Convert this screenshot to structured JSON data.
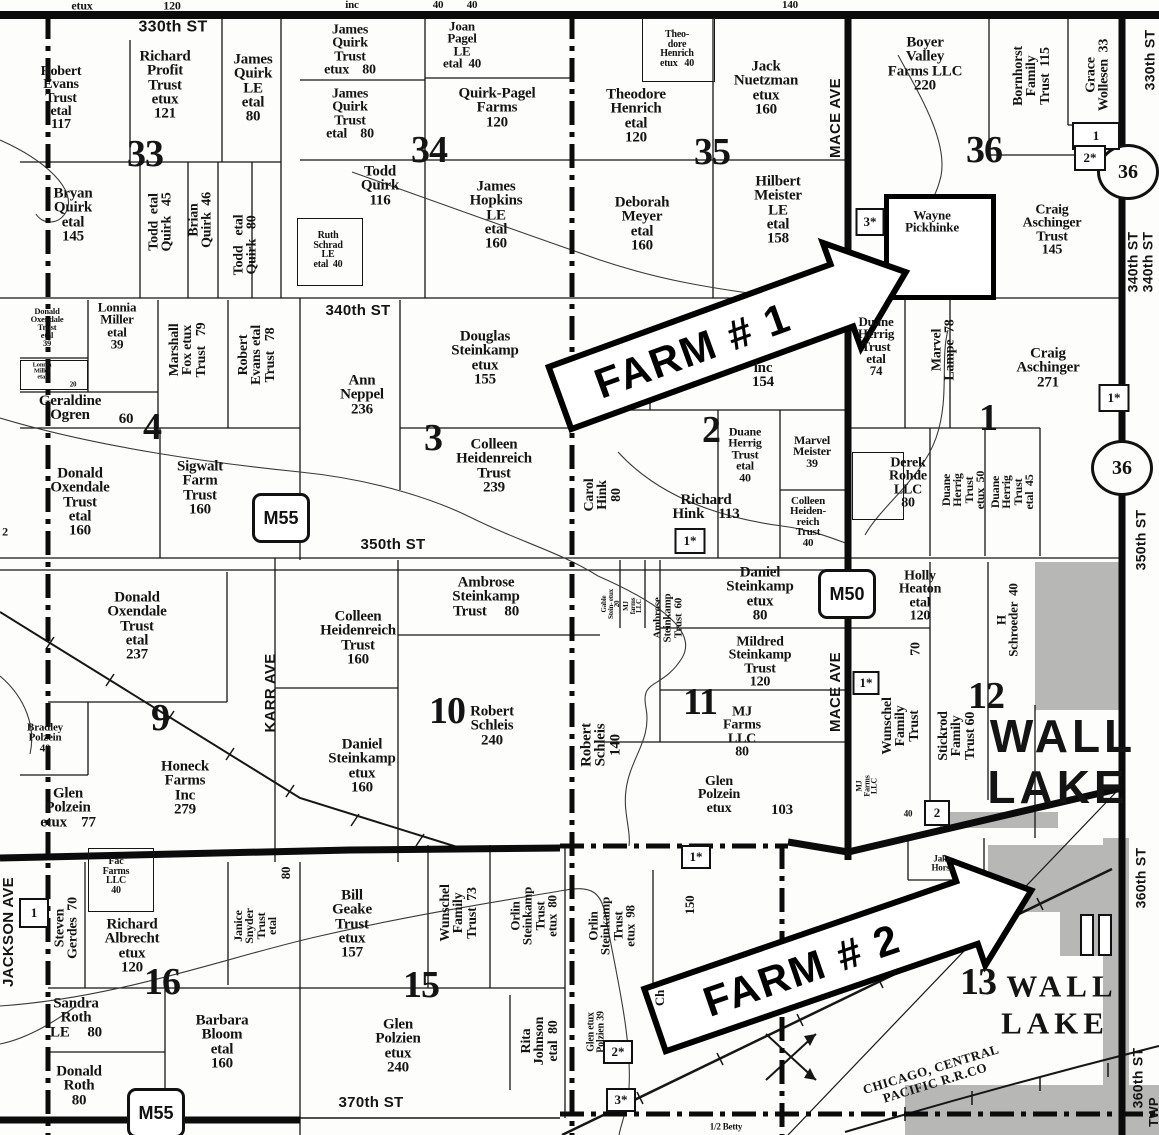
{
  "map": {
    "sections": [
      {
        "t": "33",
        "x": 145,
        "y": 154
      },
      {
        "t": "34",
        "x": 429,
        "y": 150
      },
      {
        "t": "35",
        "x": 712,
        "y": 152
      },
      {
        "t": "36",
        "x": 984,
        "y": 150
      },
      {
        "t": "4",
        "x": 152,
        "y": 427
      },
      {
        "t": "3",
        "x": 433,
        "y": 438
      },
      {
        "t": "2",
        "x": 711,
        "y": 430
      },
      {
        "t": "1",
        "x": 988,
        "y": 418
      },
      {
        "t": "9",
        "x": 160,
        "y": 718
      },
      {
        "t": "10",
        "x": 447,
        "y": 711
      },
      {
        "t": "11",
        "x": 700,
        "y": 702
      },
      {
        "t": "12",
        "x": 986,
        "y": 696
      },
      {
        "t": "16",
        "x": 162,
        "y": 982
      },
      {
        "t": "15",
        "x": 421,
        "y": 985
      },
      {
        "t": "13",
        "x": 978,
        "y": 982
      }
    ],
    "parcels_h": [
      {
        "t": "Robert\nEvans\nTrust\netal\n117",
        "x": 61,
        "y": 98,
        "s": 14
      },
      {
        "t": "Richard\nProfit\nTrust\netux\n121",
        "x": 165,
        "y": 85,
        "s": 15
      },
      {
        "t": "James\nQuirk\nLE\netal\n80",
        "x": 253,
        "y": 88,
        "s": 15
      },
      {
        "t": "Bryan\nQuirk\netal\n145",
        "x": 73,
        "y": 215,
        "s": 15
      },
      {
        "t": "James\nQuirk\nTrust\netux    80",
        "x": 350,
        "y": 50,
        "s": 14
      },
      {
        "t": "Joan\nPagel\nLE\netal  40",
        "x": 462,
        "y": 45,
        "s": 13
      },
      {
        "t": "James\nQuirk\nTrust\netal    80",
        "x": 350,
        "y": 114,
        "s": 14
      },
      {
        "t": "Quirk-Pagel\nFarms\n120",
        "x": 497,
        "y": 108,
        "s": 15
      },
      {
        "t": "Todd\nQuirk\n116",
        "x": 380,
        "y": 186,
        "s": 15
      },
      {
        "t": "James\nHopkins\nLE\netal\n160",
        "x": 496,
        "y": 215,
        "s": 15
      },
      {
        "t": "Ruth\nSchrad\nLE\netal  40",
        "x": 328,
        "y": 250,
        "s": 10
      },
      {
        "t": "Theo-\ndore\nHenrich\netux   40",
        "x": 677,
        "y": 49,
        "s": 10
      },
      {
        "t": "Jack\nNuetzman\netux\n160",
        "x": 766,
        "y": 88,
        "s": 15
      },
      {
        "t": "Theodore\nHenrich\netal\n120",
        "x": 636,
        "y": 116,
        "s": 15
      },
      {
        "t": "Deborah\nMeyer\netal\n160",
        "x": 642,
        "y": 224,
        "s": 15
      },
      {
        "t": "Hilbert\nMeister\nLE\netal\n158",
        "x": 778,
        "y": 210,
        "s": 15
      },
      {
        "t": "Boyer\nValley\nFarms LLC\n220",
        "x": 925,
        "y": 64,
        "s": 15
      },
      {
        "t": "Wayne\nPickhinke",
        "x": 932,
        "y": 222,
        "s": 13
      },
      {
        "t": "Craig\nAschinger\nTrust\n145",
        "x": 1052,
        "y": 230,
        "s": 14
      },
      {
        "t": "Donald\nOxendale\nTrust\netal\n39",
        "x": 47,
        "y": 327,
        "s": 8.5
      },
      {
        "t": "Lonnia\nMiller\netal\n39",
        "x": 117,
        "y": 326,
        "s": 13
      },
      {
        "t": "Lonnia\nMiller\netal",
        "x": 42,
        "y": 372,
        "s": 6.5
      },
      {
        "t": "20",
        "x": 73,
        "y": 385,
        "s": 7
      },
      {
        "t": "Geraldine\nOgren",
        "x": 70,
        "y": 408,
        "s": 15
      },
      {
        "t": "60",
        "x": 126,
        "y": 419,
        "s": 15
      },
      {
        "t": "Donald\nOxendale\nTrust\netal\n160",
        "x": 80,
        "y": 502,
        "s": 15
      },
      {
        "t": "Sigwalt\nFarm\nTrust\n160",
        "x": 200,
        "y": 488,
        "s": 15
      },
      {
        "t": "Ann\nNeppel\n236",
        "x": 362,
        "y": 395,
        "s": 15
      },
      {
        "t": "Douglas\nSteinkamp\netux\n155",
        "x": 485,
        "y": 358,
        "s": 15
      },
      {
        "t": "Colleen\nHeidenreich\nTrust\n239",
        "x": 494,
        "y": 466,
        "s": 15
      },
      {
        "t": "inc\n154",
        "x": 763,
        "y": 375,
        "s": 15
      },
      {
        "t": "Duane\nHerrig\nTrust\netal\n40",
        "x": 745,
        "y": 455,
        "s": 12
      },
      {
        "t": "Marvel\nMeister\n39",
        "x": 812,
        "y": 452,
        "s": 12
      },
      {
        "t": "Richard\nHink    113",
        "x": 706,
        "y": 507,
        "s": 15
      },
      {
        "t": "Colleen\nHeiden-\nreich\nTrust\n40",
        "x": 808,
        "y": 522,
        "s": 11
      },
      {
        "t": "Duane\nHerrig\nTrust\netal\n74",
        "x": 876,
        "y": 347,
        "s": 13
      },
      {
        "t": "Craig\nAschinger\n271",
        "x": 1048,
        "y": 368,
        "s": 15
      },
      {
        "t": "Derek\nRohde\nLLC\n80",
        "x": 908,
        "y": 483,
        "s": 14
      },
      {
        "t": "Donald\nOxendale\nTrust\netal\n237",
        "x": 137,
        "y": 626,
        "s": 15
      },
      {
        "t": "Bradley\nPolzein\n40",
        "x": 45,
        "y": 738,
        "s": 11
      },
      {
        "t": "Glen\nPolzein\netux    77",
        "x": 68,
        "y": 808,
        "s": 15
      },
      {
        "t": "Honeck\nFarms\nInc\n279",
        "x": 185,
        "y": 788,
        "s": 15
      },
      {
        "t": "Colleen\nHeidenreich\nTrust\n160",
        "x": 358,
        "y": 638,
        "s": 15
      },
      {
        "t": "Ambrose\nSteinkamp\nTrust     80",
        "x": 486,
        "y": 597,
        "s": 15
      },
      {
        "t": "Robert\nSchleis\n240",
        "x": 492,
        "y": 726,
        "s": 15
      },
      {
        "t": "Daniel\nSteinkamp\netux\n160",
        "x": 362,
        "y": 766,
        "s": 15
      },
      {
        "t": "Daniel\nSteinkamp\netux\n80",
        "x": 760,
        "y": 594,
        "s": 15
      },
      {
        "t": "Mildred\nSteinkamp\nTrust\n120",
        "x": 760,
        "y": 662,
        "s": 14
      },
      {
        "t": "MJ\nFarms\nLLC\n80",
        "x": 742,
        "y": 732,
        "s": 14
      },
      {
        "t": "Glen\nPolzein\netux",
        "x": 719,
        "y": 795,
        "s": 14
      },
      {
        "t": "103",
        "x": 782,
        "y": 810,
        "s": 15
      },
      {
        "t": "Holly\nHeaton\netal\n120",
        "x": 920,
        "y": 596,
        "s": 14
      },
      {
        "t": "40",
        "x": 908,
        "y": 814,
        "s": 9
      },
      {
        "t": "Fac\nFarms\nLLC\n40",
        "x": 116,
        "y": 876,
        "s": 10
      },
      {
        "t": "Richard\nAlbrecht\netux\n120",
        "x": 132,
        "y": 946,
        "s": 15
      },
      {
        "t": "Sandra\nRoth\nLE     80",
        "x": 76,
        "y": 1018,
        "s": 15
      },
      {
        "t": "Barbara\nBloom\netal\n160",
        "x": 222,
        "y": 1042,
        "s": 15
      },
      {
        "t": "Donald\nRoth\n80",
        "x": 79,
        "y": 1086,
        "s": 15
      },
      {
        "t": "Bill\nGeake\nTrust\netux\n157",
        "x": 352,
        "y": 924,
        "s": 15
      },
      {
        "t": "Glen\nPolzien\netux\n240",
        "x": 398,
        "y": 1046,
        "s": 15
      },
      {
        "t": "Jake\nHorst",
        "x": 942,
        "y": 863,
        "s": 9
      },
      {
        "t": "1/2 Betty",
        "x": 726,
        "y": 1127,
        "s": 9
      }
    ],
    "parcels_v": [
      {
        "t": "Todd  etal\nQuirk   45",
        "x": 161,
        "y": 222,
        "s": 14
      },
      {
        "t": "Brian\nQuirk  46",
        "x": 201,
        "y": 220,
        "s": 14
      },
      {
        "t": "Todd   etal\nQuirk   80",
        "x": 246,
        "y": 245,
        "s": 14
      },
      {
        "t": "Marshall\nFox etux\nTrust   79",
        "x": 188,
        "y": 350,
        "s": 14
      },
      {
        "t": "Robert\nEvans etal\nTrust   78",
        "x": 257,
        "y": 355,
        "s": 14
      },
      {
        "t": "Carol\nHink\n80",
        "x": 603,
        "y": 495,
        "s": 14
      },
      {
        "t": "Marvel\nLampe  78",
        "x": 944,
        "y": 350,
        "s": 14
      },
      {
        "t": "Duane\nHerrig\nTrust\netux  50",
        "x": 964,
        "y": 490,
        "s": 12
      },
      {
        "t": "Duane\nHerrig\nTrust\netal  45",
        "x": 1013,
        "y": 492,
        "s": 12
      },
      {
        "t": "Bornhorst\nFamily\nTrust  115",
        "x": 1032,
        "y": 76,
        "s": 14
      },
      {
        "t": "Grace\nWollesen  33",
        "x": 1098,
        "y": 75,
        "s": 14
      },
      {
        "t": "Robert\nSchleis\n140",
        "x": 601,
        "y": 745,
        "s": 15
      },
      {
        "t": "Ambrose\nSteinkamp\nTrust  60",
        "x": 668,
        "y": 618,
        "s": 11
      },
      {
        "t": "Gable\nStein- etux\n20",
        "x": 611,
        "y": 604,
        "s": 7
      },
      {
        "t": "MJ\nfarms\nLLC",
        "x": 633,
        "y": 606,
        "s": 7
      },
      {
        "t": "Wunschel\nFamily\nTrust",
        "x": 901,
        "y": 726,
        "s": 14
      },
      {
        "t": "Stickrod\nFamily\nTrust 60",
        "x": 957,
        "y": 736,
        "s": 14
      },
      {
        "t": "H\nSchroeder  40",
        "x": 1008,
        "y": 620,
        "s": 13
      },
      {
        "t": "70",
        "x": 916,
        "y": 649,
        "s": 14
      },
      {
        "t": "Steven\nGerdes  70",
        "x": 67,
        "y": 928,
        "s": 14
      },
      {
        "t": "Janice\nSnyder\nTrust\netal",
        "x": 256,
        "y": 926,
        "s": 12
      },
      {
        "t": "80",
        "x": 286,
        "y": 873,
        "s": 13
      },
      {
        "t": "Wunschel\nFamily\nTrust  73",
        "x": 459,
        "y": 913,
        "s": 14
      },
      {
        "t": "Orlin\nSteinkamp\nTrust\netux  80",
        "x": 534,
        "y": 916,
        "s": 13
      },
      {
        "t": "Orlin\nSteinkamp\nTrust\netux  98",
        "x": 612,
        "y": 926,
        "s": 13
      },
      {
        "t": "Rita\nJohnson\netal  80",
        "x": 540,
        "y": 1041,
        "s": 14
      },
      {
        "t": "Glen etux\nPolzien 39",
        "x": 596,
        "y": 1032,
        "s": 10
      },
      {
        "t": "150",
        "x": 690,
        "y": 905,
        "s": 13
      },
      {
        "t": "Ch",
        "x": 660,
        "y": 998,
        "s": 13
      },
      {
        "t": "MJ\nFarms\nLLC",
        "x": 867,
        "y": 786,
        "s": 8
      }
    ],
    "road_labels_h": [
      {
        "t": "330th ST",
        "x": 173,
        "y": 27,
        "s": 16
      },
      {
        "t": "340th ST",
        "x": 358,
        "y": 311,
        "s": 15
      },
      {
        "t": "350th ST",
        "x": 393,
        "y": 545,
        "s": 15
      },
      {
        "t": "370th ST",
        "x": 371,
        "y": 1103,
        "s": 15
      }
    ],
    "road_labels_v": [
      {
        "t": "MACE AVE",
        "x": 836,
        "y": 118,
        "s": 15
      },
      {
        "t": "MACE AVE",
        "x": 836,
        "y": 692,
        "s": 15
      },
      {
        "t": "KARR AVE",
        "x": 271,
        "y": 693,
        "s": 15
      },
      {
        "t": "JACKSON AVE",
        "x": 9,
        "y": 932,
        "s": 15
      },
      {
        "t": "330th ST",
        "x": 1150,
        "y": 60,
        "s": 14
      },
      {
        "t": "340th ST",
        "x": 1133,
        "y": 262,
        "s": 14
      },
      {
        "t": "340th ST",
        "x": 1148,
        "y": 262,
        "s": 14
      },
      {
        "t": "350th ST",
        "x": 1141,
        "y": 540,
        "s": 14
      },
      {
        "t": "360th ST",
        "x": 1141,
        "y": 878,
        "s": 14
      },
      {
        "t": "360th ST",
        "x": 1138,
        "y": 1078,
        "s": 14
      },
      {
        "t": "TWP",
        "x": 1154,
        "y": 1112,
        "s": 13
      }
    ],
    "fragments": [
      {
        "t": "etux",
        "x": 82,
        "y": 6,
        "s": 12
      },
      {
        "t": "120",
        "x": 172,
        "y": 6,
        "s": 12
      },
      {
        "t": "inc",
        "x": 352,
        "y": 5,
        "s": 11
      },
      {
        "t": "40",
        "x": 438,
        "y": 5,
        "s": 11
      },
      {
        "t": "40",
        "x": 472,
        "y": 5,
        "s": 11
      },
      {
        "t": "140",
        "x": 790,
        "y": 5,
        "s": 11
      },
      {
        "t": "2",
        "x": 5,
        "y": 532,
        "s": 12
      }
    ],
    "route_boxes": [
      {
        "t": "M55",
        "x": 281,
        "y": 518
      },
      {
        "t": "M50",
        "x": 847,
        "y": 594
      },
      {
        "t": "M55",
        "x": 156,
        "y": 1113
      }
    ],
    "route_circles": [
      {
        "t": "36",
        "x": 1128,
        "y": 172
      },
      {
        "t": "36",
        "x": 1122,
        "y": 468
      }
    ],
    "small_boxes": [
      {
        "t": "1",
        "x": 1096,
        "y": 136,
        "w": 44,
        "h": 24
      },
      {
        "t": "2*",
        "x": 1090,
        "y": 158,
        "w": 28,
        "h": 22
      },
      {
        "t": "3*",
        "x": 870,
        "y": 222,
        "w": 25,
        "h": 24
      },
      {
        "t": "1*",
        "x": 1114,
        "y": 398,
        "w": 27,
        "h": 24
      },
      {
        "t": "1*",
        "x": 690,
        "y": 541,
        "w": 27,
        "h": 22
      },
      {
        "t": "1*",
        "x": 866,
        "y": 683,
        "w": 23,
        "h": 20
      },
      {
        "t": "2",
        "x": 937,
        "y": 813,
        "w": 22,
        "h": 22
      },
      {
        "t": "1",
        "x": 34,
        "y": 913,
        "w": 26,
        "h": 26
      },
      {
        "t": "1*",
        "x": 696,
        "y": 857,
        "w": 26,
        "h": 20
      },
      {
        "t": "2*",
        "x": 618,
        "y": 1052,
        "w": 26,
        "h": 20
      },
      {
        "t": "3*",
        "x": 621,
        "y": 1100,
        "w": 26,
        "h": 20
      }
    ],
    "wall_lake_sans": [
      {
        "t": "WALL",
        "x": 1063,
        "y": 737,
        "s": 46
      },
      {
        "t": "LAKE",
        "x": 1058,
        "y": 788,
        "s": 46
      }
    ],
    "wall_lake_serif": [
      {
        "t": "WALL",
        "x": 1062,
        "y": 986,
        "s": 31
      },
      {
        "t": "LAKE",
        "x": 1055,
        "y": 1023,
        "s": 31
      }
    ],
    "railroad_label": {
      "t": "CHICAGO, CENTRAL\nPACIFIC R.R.CO",
      "x": 933,
      "y": 1076,
      "rot": -17,
      "s": 13
    },
    "arrows": [
      {
        "t": "FARM # 1",
        "x": 560,
        "y": 398,
        "rot": -20,
        "len": 300
      },
      {
        "t": "FARM # 2",
        "x": 655,
        "y": 1020,
        "rot": -19,
        "len": 330
      }
    ]
  }
}
